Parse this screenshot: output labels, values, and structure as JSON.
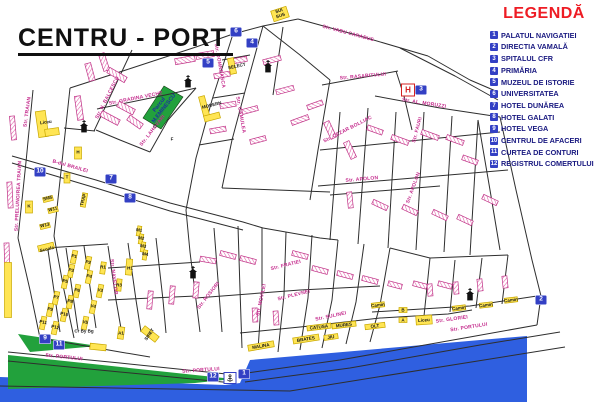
{
  "title": "CENTRU - PORT",
  "legend": {
    "title": "LEGENDĂ",
    "items": [
      {
        "num": "1",
        "label": "PALATUL NAVIGATIEI"
      },
      {
        "num": "2",
        "label": "DIRECTIA VAMALĂ"
      },
      {
        "num": "3",
        "label": "SPITALUL CFR"
      },
      {
        "num": "4",
        "label": "PRIMĂRIA"
      },
      {
        "num": "5",
        "label": "MUZEUL DE ISTORIE"
      },
      {
        "num": "6",
        "label": "UNIVERSITATEA"
      },
      {
        "num": "7",
        "label": "HOTEL DUNĂREA"
      },
      {
        "num": "8",
        "label": "HOTEL GALATI"
      },
      {
        "num": "9",
        "label": "HOTEL VEGA"
      },
      {
        "num": "10",
        "label": "CENTRUL DE AFACERI"
      },
      {
        "num": "11",
        "label": "CURTEA DE CONTURI"
      },
      {
        "num": "12",
        "label": "REGISTRUL COMERTULUI"
      }
    ]
  },
  "map": {
    "street_labels": [
      {
        "t": "Str. TRAIAN",
        "x": 28,
        "y": 112,
        "r": -82
      },
      {
        "t": "Str. PRELUNGIREA TRAIAN",
        "x": 19,
        "y": 196,
        "r": -87
      },
      {
        "t": "B-dul BRAILEI",
        "x": 70,
        "y": 167,
        "r": 16
      },
      {
        "t": "Str. DOMNEASCA",
        "x": 219,
        "y": 66,
        "r": 80
      },
      {
        "t": "Str. N. BALCESCU",
        "x": 108,
        "y": 98,
        "r": -63
      },
      {
        "t": "Str. GRADINA VECHE",
        "x": 136,
        "y": 99,
        "r": -11
      },
      {
        "t": "Str. LAHOVARI",
        "x": 153,
        "y": 131,
        "r": -52
      },
      {
        "t": "Str. VADU CARABUS",
        "x": 348,
        "y": 34,
        "r": 15
      },
      {
        "t": "Str. RASARITULUI",
        "x": 363,
        "y": 77,
        "r": -5
      },
      {
        "t": "Str. AL. MORUZZI",
        "x": 424,
        "y": 104,
        "r": 9
      },
      {
        "t": "Str. PORTULUI",
        "x": 64,
        "y": 358,
        "r": 6
      },
      {
        "t": "Str. PORTULUI",
        "x": 201,
        "y": 371,
        "r": -4
      },
      {
        "t": "Str. PORTULUI",
        "x": 469,
        "y": 328,
        "r": -9
      },
      {
        "t": "Str. NAVELOR",
        "x": 113,
        "y": 277,
        "r": 83
      },
      {
        "t": "Str. APOLON",
        "x": 362,
        "y": 180,
        "r": -5
      },
      {
        "t": "Str. APOLON",
        "x": 414,
        "y": 188,
        "r": -70
      },
      {
        "t": "Str. CEZAR BOLLIAC",
        "x": 348,
        "y": 130,
        "r": -27
      },
      {
        "t": "Str. GAMULEA",
        "x": 240,
        "y": 115,
        "r": 80
      },
      {
        "t": "Str. ROSIORI",
        "x": 209,
        "y": 296,
        "r": -52
      },
      {
        "t": "Str. SULINEI",
        "x": 331,
        "y": 317,
        "r": -12
      },
      {
        "t": "Str. PLEVNEI",
        "x": 294,
        "y": 296,
        "r": -14
      },
      {
        "t": "Str. FRATIEI",
        "x": 286,
        "y": 266,
        "r": -14
      },
      {
        "t": "Str. MOVILEI",
        "x": 262,
        "y": 300,
        "r": -78
      },
      {
        "t": "Str. GLORIEI",
        "x": 452,
        "y": 320,
        "r": -8
      },
      {
        "t": "Str. FAURI",
        "x": 418,
        "y": 130,
        "r": -75
      }
    ],
    "area_labels": [
      {
        "t": "Parcul\nM.EMINESCU",
        "x": 162,
        "y": 107,
        "r": -52
      }
    ],
    "building_labels": [
      {
        "t": "Liceu",
        "x": 46,
        "y": 123,
        "r": -8
      },
      {
        "t": "MODERN",
        "x": 212,
        "y": 106,
        "r": -14
      },
      {
        "t": "SELECT",
        "x": 237,
        "y": 67,
        "r": -12
      },
      {
        "t": "SUI\nSUS",
        "x": 280,
        "y": 14,
        "r": -18
      },
      {
        "t": "Scoala",
        "x": 47,
        "y": 250,
        "r": -14
      },
      {
        "t": "P1",
        "x": 74,
        "y": 257,
        "r": 12
      },
      {
        "t": "P2",
        "x": 88,
        "y": 263,
        "r": 12
      },
      {
        "t": "P3",
        "x": 71,
        "y": 271,
        "r": 12
      },
      {
        "t": "P4",
        "x": 89,
        "y": 277,
        "r": 12
      },
      {
        "t": "P5",
        "x": 65,
        "y": 282,
        "r": 12
      },
      {
        "t": "P6",
        "x": 77,
        "y": 291,
        "r": 12
      },
      {
        "t": "P7",
        "x": 56,
        "y": 298,
        "r": 12
      },
      {
        "t": "P8",
        "x": 70,
        "y": 302,
        "r": 12
      },
      {
        "t": "P9",
        "x": 50,
        "y": 310,
        "r": 12
      },
      {
        "t": "P10",
        "x": 64,
        "y": 315,
        "r": 12
      },
      {
        "t": "P11",
        "x": 43,
        "y": 323,
        "r": 12
      },
      {
        "t": "P12",
        "x": 55,
        "y": 328,
        "r": 12
      },
      {
        "t": "V3",
        "x": 100,
        "y": 291,
        "r": 12
      },
      {
        "t": "V4",
        "x": 93,
        "y": 307,
        "r": 12
      },
      {
        "t": "V5",
        "x": 85,
        "y": 323,
        "r": 12
      },
      {
        "t": "Cr By Bg",
        "x": 84,
        "y": 332,
        "r": 0
      },
      {
        "t": "R1",
        "x": 103,
        "y": 268,
        "r": 0
      },
      {
        "t": "H1",
        "x": 130,
        "y": 269,
        "r": 0
      },
      {
        "t": "R3",
        "x": 119,
        "y": 286,
        "r": 0
      },
      {
        "t": "M1",
        "x": 139,
        "y": 231,
        "r": 10
      },
      {
        "t": "M2",
        "x": 141,
        "y": 239,
        "r": 10
      },
      {
        "t": "M3",
        "x": 143,
        "y": 247,
        "r": 10
      },
      {
        "t": "M4",
        "x": 145,
        "y": 255,
        "r": 10
      },
      {
        "t": "K",
        "x": 29,
        "y": 207,
        "r": 0
      },
      {
        "t": "T",
        "x": 67,
        "y": 178,
        "r": 0
      },
      {
        "t": "H",
        "x": 78,
        "y": 153,
        "r": 0
      },
      {
        "t": "TRAP",
        "x": 84,
        "y": 200,
        "r": -75
      },
      {
        "t": "SM5",
        "x": 48,
        "y": 199,
        "r": -14
      },
      {
        "t": "W11",
        "x": 53,
        "y": 210,
        "r": -14
      },
      {
        "t": "W13",
        "x": 45,
        "y": 226,
        "r": -14
      },
      {
        "t": "MALINA",
        "x": 261,
        "y": 347,
        "r": -10
      },
      {
        "t": "BRATES",
        "x": 306,
        "y": 340,
        "r": -9
      },
      {
        "t": "JIU",
        "x": 331,
        "y": 338,
        "r": -8
      },
      {
        "t": "CATUSA",
        "x": 319,
        "y": 328,
        "r": -7
      },
      {
        "t": "MURES",
        "x": 344,
        "y": 326,
        "r": -7
      },
      {
        "t": "OLT",
        "x": 375,
        "y": 327,
        "r": -7
      },
      {
        "t": "Camin",
        "x": 378,
        "y": 306,
        "r": -7
      },
      {
        "t": "Camin",
        "x": 459,
        "y": 309,
        "r": -7
      },
      {
        "t": "Camin",
        "x": 486,
        "y": 306,
        "r": -7
      },
      {
        "t": "Camin",
        "x": 511,
        "y": 301,
        "r": -7
      },
      {
        "t": "B",
        "x": 403,
        "y": 311,
        "r": 0
      },
      {
        "t": "A",
        "x": 403,
        "y": 321,
        "r": 0
      },
      {
        "t": "Liceu",
        "x": 424,
        "y": 321,
        "r": -4
      },
      {
        "t": "SIRET",
        "x": 150,
        "y": 335,
        "r": -55
      },
      {
        "t": "A1",
        "x": 121,
        "y": 334,
        "r": 0
      },
      {
        "t": "C",
        "x": 155,
        "y": 127,
        "r": 0
      },
      {
        "t": "F",
        "x": 172,
        "y": 140,
        "r": 0
      }
    ],
    "markers": [
      {
        "num": "1",
        "x": 244,
        "y": 374
      },
      {
        "num": "2",
        "x": 541,
        "y": 300
      },
      {
        "num": "3",
        "x": 421,
        "y": 90
      },
      {
        "num": "4",
        "x": 252,
        "y": 43
      },
      {
        "num": "5",
        "x": 208,
        "y": 63
      },
      {
        "num": "6",
        "x": 236,
        "y": 32
      },
      {
        "num": "7",
        "x": 111,
        "y": 179
      },
      {
        "num": "8",
        "x": 130,
        "y": 198
      },
      {
        "num": "9",
        "x": 45,
        "y": 339
      },
      {
        "num": "10",
        "x": 40,
        "y": 172
      },
      {
        "num": "11",
        "x": 59,
        "y": 345
      },
      {
        "num": "12",
        "x": 213,
        "y": 377
      }
    ],
    "icons": {
      "churches": [
        {
          "x": 84,
          "y": 126
        },
        {
          "x": 188,
          "y": 81
        },
        {
          "x": 268,
          "y": 66
        },
        {
          "x": 193,
          "y": 272
        },
        {
          "x": 470,
          "y": 294
        }
      ],
      "anchor": {
        "x": 230,
        "y": 378
      },
      "hospital": {
        "x": 408,
        "y": 90,
        "label": "H"
      }
    },
    "colors": {
      "water": "#2f5fe0",
      "park": "#22a13c",
      "street": "#2e2e2e",
      "building_yellow": "#ffe554",
      "building_pink": "#e05aa5",
      "marker_blue": "#3340c4",
      "legend_red": "#ee1c24",
      "legend_text": "#191980",
      "street_label": "#c42a8c"
    }
  }
}
